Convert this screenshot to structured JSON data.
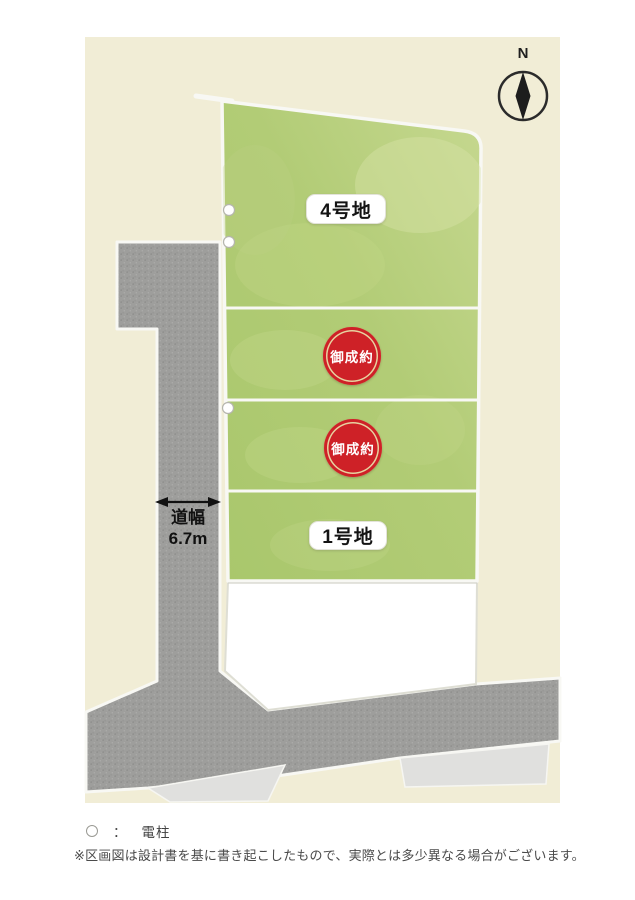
{
  "compass": {
    "label": "N"
  },
  "map": {
    "lots": [
      {
        "id": "lot-4",
        "label": "4号地",
        "status": "available"
      },
      {
        "id": "lot-3",
        "label": "御成約",
        "status": "sold"
      },
      {
        "id": "lot-2",
        "label": "御成約",
        "status": "sold"
      },
      {
        "id": "lot-1",
        "label": "1号地",
        "status": "available"
      }
    ],
    "road_width": {
      "line1": "道幅",
      "line2": "6.7m"
    },
    "pole_count": 3,
    "colors": {
      "background_paper": "#ffffff",
      "map_ground": "#f1edd6",
      "lot_green": "#b0cb74",
      "road_gray": "#9e9e9c",
      "sidewalk_gray": "#e0e0de",
      "sold_red": "#ce2127",
      "border_white": "#f8f8f4"
    }
  },
  "legend": {
    "symbol": "○",
    "separator": "：",
    "item_label": "電柱"
  },
  "note": "※区画図は設計書を基に書き起こしたもので、実際とは多少異なる場合がございます。"
}
